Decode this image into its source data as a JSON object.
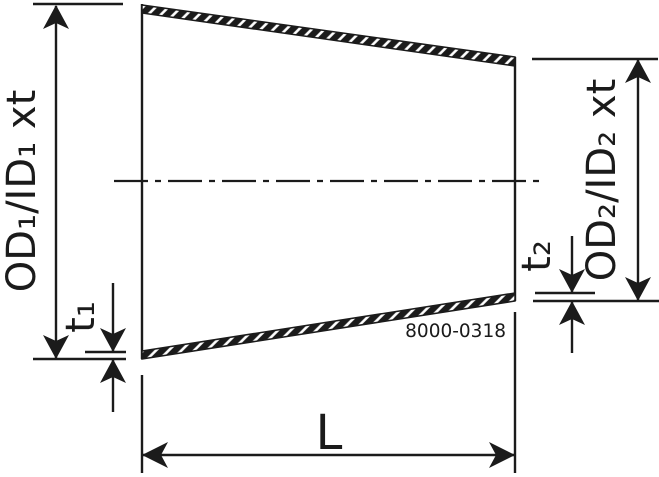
{
  "drawing": {
    "labels": {
      "od1": "OD₁/ID₁ xt",
      "t1": "t₁",
      "od2": "OD₂/ID₂ xt",
      "t2": "t₂",
      "length": "L",
      "drawing_number": "8000-0318"
    },
    "colors": {
      "line": "#1b1b1b",
      "background": "#ffffff"
    }
  }
}
